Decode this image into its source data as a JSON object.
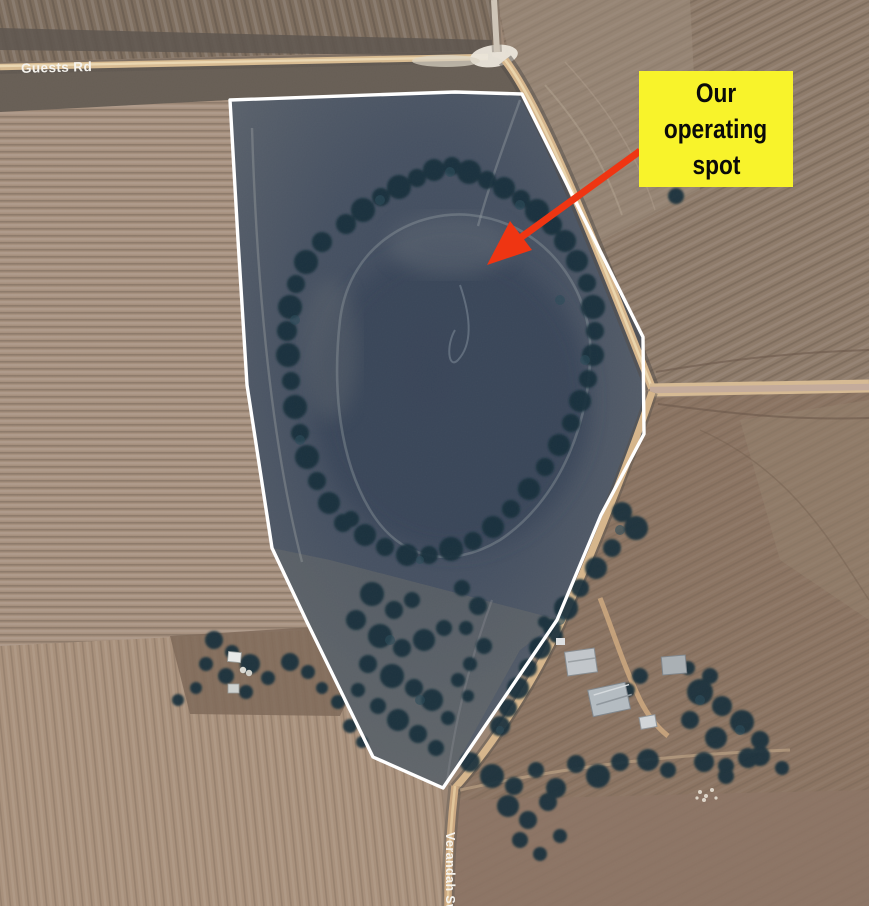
{
  "annotation": {
    "full_text": "Our operating spot",
    "lines": [
      "Our",
      "operating",
      "spot"
    ],
    "bg_color": "#F8F32B",
    "text_color": "#0A0A0A",
    "arrow_color": "#EF3512"
  },
  "road_labels": {
    "guests_rd": "Guests Rd",
    "verandah_sw": "Verandah Sw"
  },
  "property_outline": {
    "color": "#FFFFFF",
    "shape": "polygon around dark swamp paddock"
  },
  "map_colors": {
    "field_tan": "#A18C7B",
    "field_brown": "#8A7361",
    "swamp_dark": "#3F4B5F",
    "trees_dark": "#142E3A",
    "road_tan": "#D7B68C"
  }
}
